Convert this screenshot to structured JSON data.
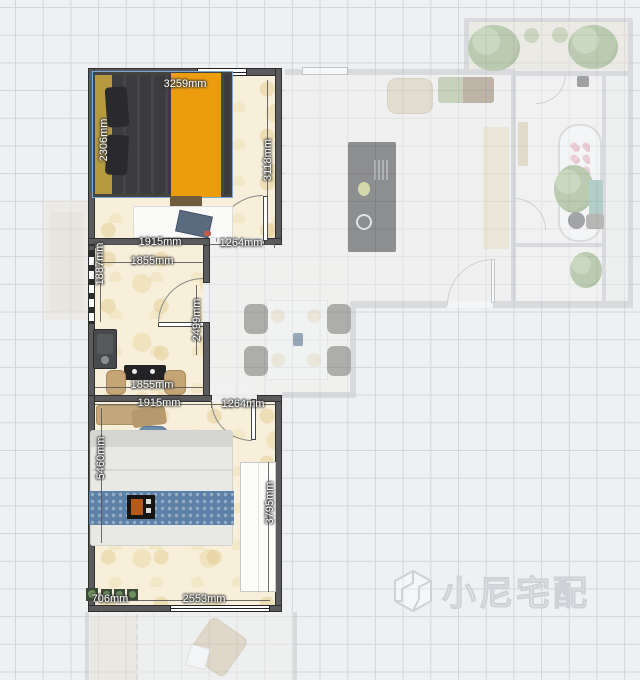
{
  "watermark": {
    "text": "小尼宅配",
    "icon": "cube-logo"
  },
  "colors": {
    "selection": "#79a8da",
    "wall_dark": "#5b5b5d",
    "wall_faded": "#c3c6ca",
    "floor_beige": "#f7efd9",
    "bed_duvet_dark": "#3c3c3e",
    "bed_runner_orange": "#ec9d0e",
    "bed_headboard_olive": "#b59a40",
    "bed2_runner_blue": "#5c80a6",
    "plant_green": "#8aa873",
    "grid_line": "#d3d6da"
  },
  "dimensions": {
    "bed_width": {
      "label": "3259mm"
    },
    "bed_depth": {
      "label": "2306mm"
    },
    "bedroom1_right_wall": {
      "label": "3118mm"
    },
    "bedroom1_bottom": {
      "label": "1915mm"
    },
    "bedroom1_door": {
      "label": "1264mm"
    },
    "kitchen_top": {
      "label": "1855mm"
    },
    "kitchen_left_window": {
      "label": "1887mm"
    },
    "kitchen_right_wall": {
      "label": "2499mm"
    },
    "kitchen_bottom": {
      "label": "1855mm"
    },
    "bedroom2_top": {
      "label": "1915mm"
    },
    "bedroom2_door": {
      "label": "1264mm"
    },
    "bedroom2_left_wall": {
      "label": "5460mm"
    },
    "bedroom2_right_wall": {
      "label": "3795mm"
    },
    "bedroom2_bottom_left": {
      "label": "706mm"
    },
    "bedroom2_window": {
      "label": "2553mm"
    }
  }
}
